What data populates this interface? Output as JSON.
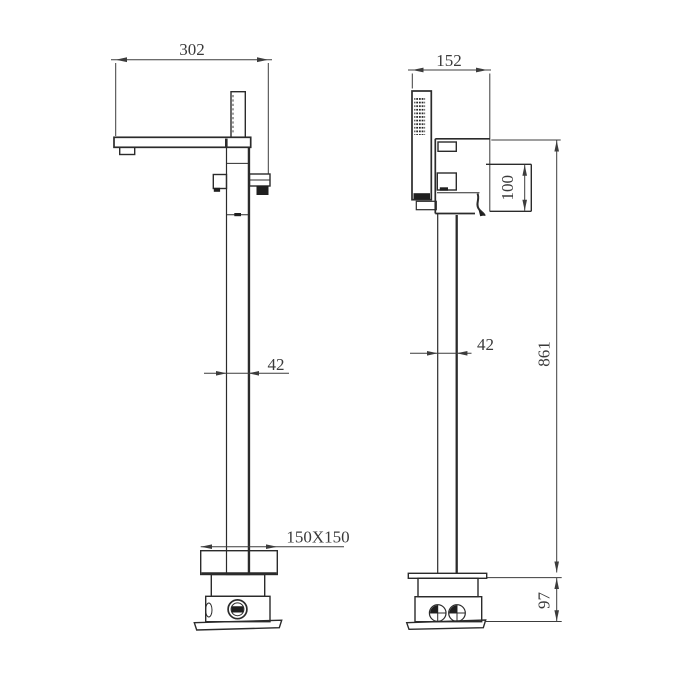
{
  "drawing": {
    "background": "#ffffff",
    "line_color": "#2b2b2b",
    "text_color": "#3a3a3a",
    "front_view": {
      "dim_spout_reach": "302",
      "dim_column_width": "42",
      "dim_base_plate": "150X150"
    },
    "side_view": {
      "dim_body_depth": "152",
      "dim_valve_height": "100",
      "dim_column_width": "42",
      "dim_overall_height": "861",
      "dim_base_height": "97"
    }
  }
}
